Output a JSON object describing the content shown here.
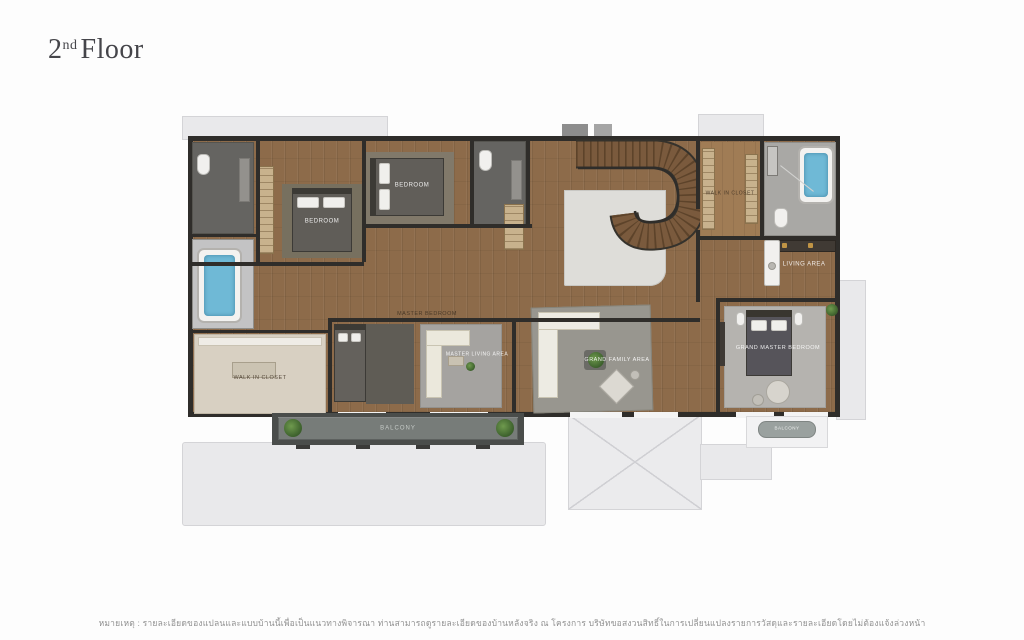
{
  "title": {
    "number": "2",
    "ordinal": "nd",
    "word": "Floor"
  },
  "plan": {
    "labels": {
      "bedroom_a": "BEDROOM",
      "bedroom_b": "BEDROOM",
      "walk_in_closet_right": "WALK IN CLOSET",
      "living_area": "LIVING AREA",
      "grand_master_bedroom": "GRAND MASTER BEDROOM",
      "master_bedroom": "MASTER BEDROOM",
      "master_living_area": "MASTER LIVING AREA",
      "walk_in_closet_left": "WALK IN CLOSET",
      "grand_family_area": "GRAND FAMILY AREA",
      "balcony": "BALCONY",
      "balcony_right": "BALCONY"
    },
    "colors": {
      "wood": "#8d6b4a",
      "wall": "#2f2d2a",
      "bathroom_dark": "#656461",
      "bathroom_light": "#a9a8a5",
      "tub_water": "#6fb9d6",
      "terrace": "#e9e9eb",
      "balcony_floor": "#777c79",
      "plant": "#4e7a3a"
    }
  },
  "footer": {
    "disclaimer": "หมายเหตุ : รายละเอียดของแปลนและแบบบ้านนี้เพื่อเป็นแนวทางพิจารณา ท่านสามารถดูรายละเอียดของบ้านหลังจริง ณ โครงการ บริษัทขอสงวนสิทธิ์ในการเปลี่ยนแปลงรายการวัสดุและรายละเอียดโดยไม่ต้องแจ้งล่วงหน้า"
  }
}
